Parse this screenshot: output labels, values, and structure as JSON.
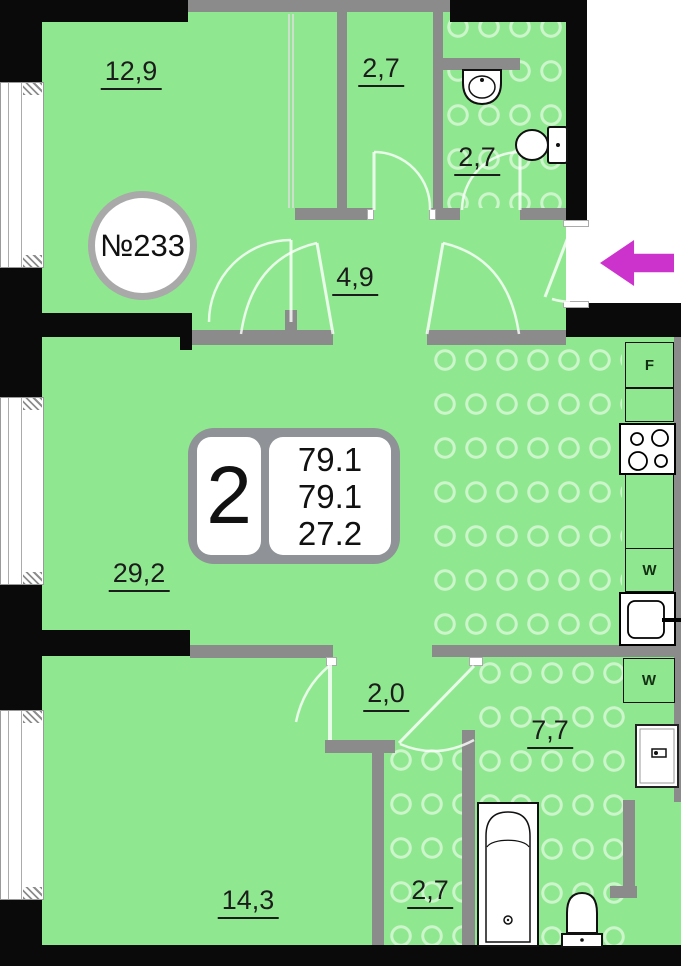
{
  "plan": {
    "title": "apartment-floor-plan",
    "apartment_number": "№233",
    "info_plate": {
      "rooms_count": "2",
      "values": [
        "79.1",
        "79.1",
        "27.2"
      ]
    },
    "entrance": {
      "arrow_direction": "left"
    }
  },
  "rooms": [
    {
      "name": "room-top-left",
      "area_label": "12,9"
    },
    {
      "name": "wardrobe",
      "area_label": "2,7"
    },
    {
      "name": "bathroom-top",
      "area_label": "2,7"
    },
    {
      "name": "hallway",
      "area_label": "4,9"
    },
    {
      "name": "living-room",
      "area_label": "29,2"
    },
    {
      "name": "inner-hall",
      "area_label": "2,0"
    },
    {
      "name": "bathroom-main",
      "area_label": "7,7"
    },
    {
      "name": "room-bottom-left",
      "area_label": "14,3"
    },
    {
      "name": "corridor",
      "area_label": "2,7"
    }
  ],
  "appliances": {
    "fridge_label": "F",
    "washer1_label": "W",
    "washer2_label": "W"
  },
  "colors": {
    "floor_green": "#8FE88F",
    "tile_ring": "#C8F5C8",
    "wall_black": "#0A0A0A",
    "wall_gray": "#8B8B8B",
    "entrance_arrow": "#CC33CC",
    "info_plate_frame": "#8F9296"
  }
}
